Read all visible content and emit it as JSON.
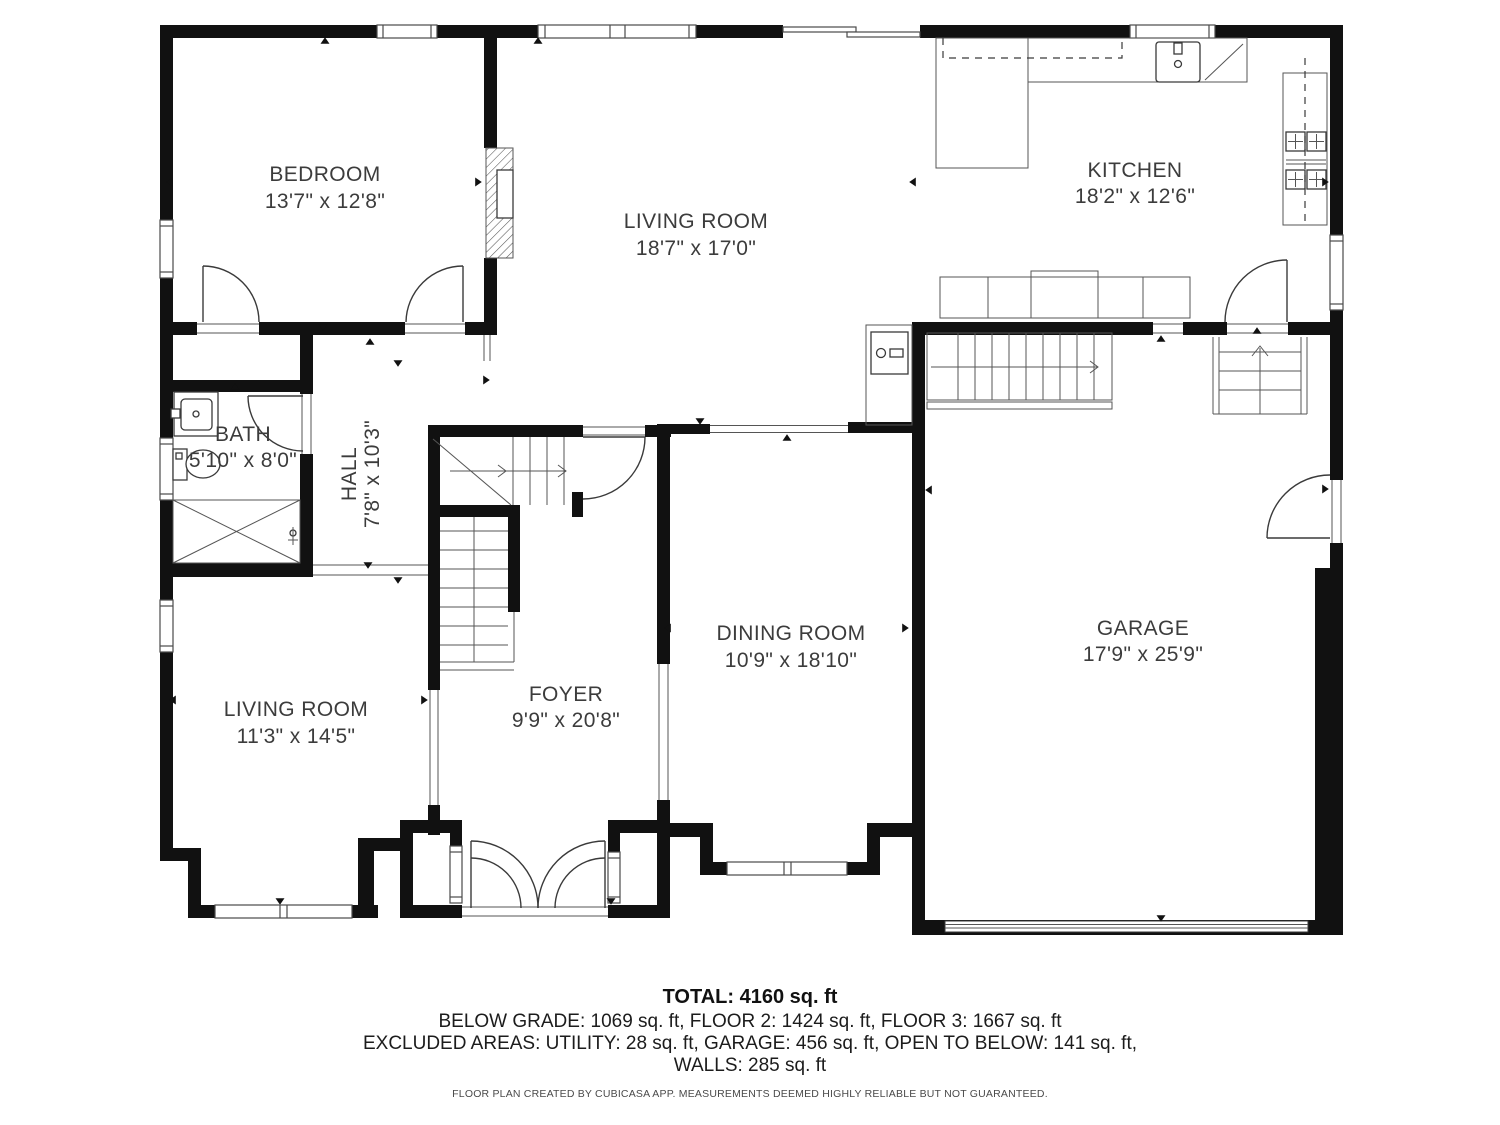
{
  "plan": {
    "rooms": [
      {
        "id": "bedroom",
        "name": "BEDROOM",
        "dims": "13'7\" x 12'8\""
      },
      {
        "id": "living-room-upper",
        "name": "LIVING ROOM",
        "dims": "18'7\" x 17'0\""
      },
      {
        "id": "kitchen",
        "name": "KITCHEN",
        "dims": "18'2\" x 12'6\""
      },
      {
        "id": "bath",
        "name": "BATH",
        "dims": "5'10\" x 8'0\""
      },
      {
        "id": "hall",
        "name": "HALL",
        "dims": "7'8\" x 10'3\""
      },
      {
        "id": "living-room-lower",
        "name": "LIVING ROOM",
        "dims": "11'3\" x 14'5\""
      },
      {
        "id": "foyer",
        "name": "FOYER",
        "dims": "9'9\" x 20'8\""
      },
      {
        "id": "dining-room",
        "name": "DINING ROOM",
        "dims": "10'9\" x 18'10\""
      },
      {
        "id": "garage",
        "name": "GARAGE",
        "dims": "17'9\" x 25'9\""
      }
    ]
  },
  "summary": {
    "total": "TOTAL: 4160 sq. ft",
    "floors": "BELOW GRADE: 1069 sq. ft, FLOOR 2: 1424 sq. ft, FLOOR 3: 1667 sq. ft",
    "excluded": "EXCLUDED AREAS: UTILITY: 28 sq. ft, GARAGE: 456 sq. ft, OPEN TO BELOW: 141 sq. ft,",
    "walls": "WALLS: 285 sq. ft",
    "disclaimer": "FLOOR PLAN CREATED BY CUBICASA APP. MEASUREMENTS DEEMED HIGHLY RELIABLE BUT NOT GUARANTEED."
  },
  "colors": {
    "wall": "#111111",
    "line": "#4a4a4a",
    "text": "#3c3c3c",
    "background": "#ffffff"
  }
}
